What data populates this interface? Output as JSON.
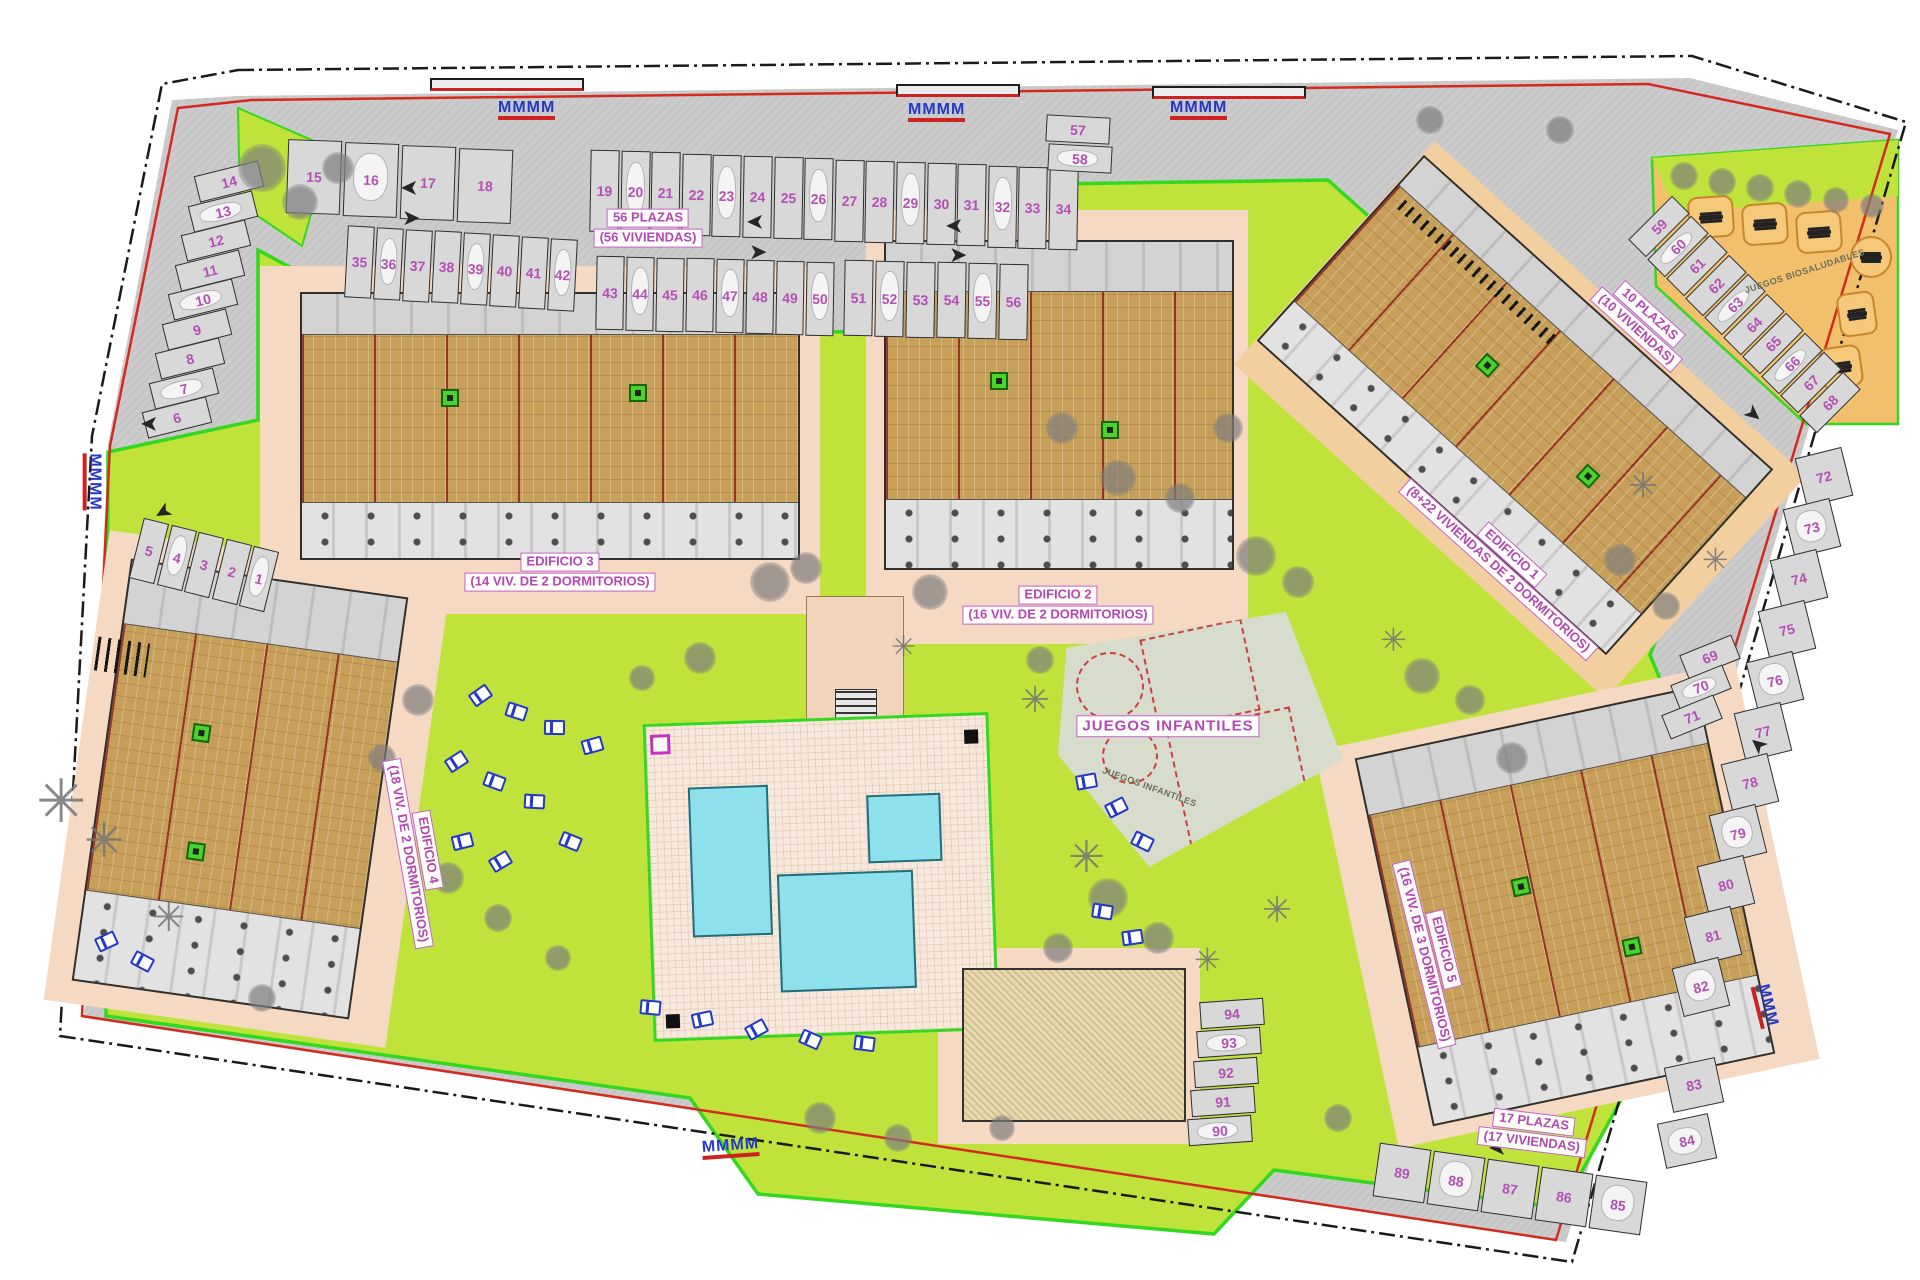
{
  "labels": {
    "plazas_top": {
      "line1": "56 PLAZAS",
      "line2": "(56 VIVIENDAS)"
    },
    "plazas_right": {
      "line1": "10 PLAZAS",
      "line2": "(10 VIVIENDAS)"
    },
    "plazas_bottom": {
      "line1": "17 PLAZAS",
      "line2": "(17 VIVIENDAS)"
    },
    "edificio1": {
      "line1": "EDIFICIO 1",
      "line2": "(8+22 VIVIENDAS DE 2 DORMITORIOS)"
    },
    "edificio2": {
      "line1": "EDIFICIO 2",
      "line2": "(16 VIV. DE 2 DORMITORIOS)"
    },
    "edificio3": {
      "line1": "EDIFICIO 3",
      "line2": "(14 VIV. DE 2 DORMITORIOS)"
    },
    "edificio4": {
      "line1": "EDIFICIO 4",
      "line2": "(18 VIV. DE 2 DORMITORIOS)"
    },
    "edificio5": {
      "line1": "EDIFICIO 5",
      "line2": "(16 VIV. DE 3 DORMITORIOS)"
    },
    "juegos_infantiles": "JUEGOS INFANTILES",
    "juegos_infantiles_small": "JUEGOS INFANTILES",
    "juegos_biosaludables": "JUEGOS BIOSALUDABLES"
  },
  "icons": {
    "arrow_glyph": "➤",
    "palm_glyph": "✳",
    "rack_glyph": "M"
  },
  "colors": {
    "parking_number": "#b44fb4",
    "label_pink": "#b348b3",
    "lime_garden": "#bfe33a",
    "boundary_green": "#33d81f",
    "boundary_red": "#d42a1e",
    "road_gray": "#cbcbcb",
    "walkway_salmon": "#f5d9c3",
    "fitness_orange": "#f2c06d",
    "building_tan": "#c79f58",
    "pool_cyan": "#8ee0ec",
    "lounger_blue": "#2338c8"
  },
  "parking_groups": [
    {
      "numbers": [
        "15",
        "16",
        "17",
        "18"
      ],
      "x": 287,
      "y": 140,
      "dx": 57,
      "dy": 3,
      "w": 54,
      "h": 74,
      "rot": 2
    },
    {
      "numbers": [
        "19",
        "20",
        "21",
        "22",
        "23",
        "24",
        "25",
        "26",
        "27",
        "28",
        "29",
        "30",
        "31",
        "32",
        "33",
        "34"
      ],
      "x": 590,
      "y": 150,
      "dx": 30.6,
      "dy": 1.2,
      "w": 29,
      "h": 82,
      "rot": 1
    },
    {
      "numbers": [
        "35",
        "36",
        "37",
        "38",
        "39",
        "40",
        "41",
        "42"
      ],
      "x": 346,
      "y": 226,
      "dx": 29,
      "dy": 1.8,
      "w": 27,
      "h": 72,
      "rot": 3
    },
    {
      "numbers": [
        "43",
        "44",
        "45",
        "46",
        "47",
        "48",
        "49",
        "50"
      ],
      "x": 596,
      "y": 256,
      "dx": 30,
      "dy": 0.8,
      "w": 28,
      "h": 74,
      "rot": 1
    },
    {
      "numbers": [
        "51",
        "52",
        "53",
        "54",
        "55",
        "56"
      ],
      "x": 844,
      "y": 260,
      "dx": 31,
      "dy": 0.8,
      "w": 29,
      "h": 76,
      "rot": 1
    },
    {
      "numbers": [
        "57",
        "58"
      ],
      "x": 1046,
      "y": 116,
      "dx": 2,
      "dy": 29,
      "w": 64,
      "h": 27,
      "rot": 3
    },
    {
      "numbers": [
        "14",
        "13",
        "12",
        "11",
        "10",
        "9",
        "8",
        "7",
        "6"
      ],
      "x": 196,
      "y": 168,
      "dx": -6.5,
      "dy": 29.5,
      "w": 66,
      "h": 27,
      "rot": -14
    },
    {
      "numbers": [
        "5",
        "4",
        "3",
        "2",
        "1"
      ],
      "x": 136,
      "y": 520,
      "dx": 27.5,
      "dy": 7,
      "w": 26,
      "h": 62,
      "rot": 14
    },
    {
      "numbers": [
        "59",
        "60",
        "61",
        "62",
        "63",
        "64",
        "65",
        "66",
        "67",
        "68"
      ],
      "x": 1628,
      "y": 214,
      "dx": 19,
      "dy": 19.5,
      "w": 62,
      "h": 25,
      "rot": -45
    },
    {
      "numbers": [
        "69",
        "70",
        "71"
      ],
      "x": 1682,
      "y": 644,
      "dx": -9,
      "dy": 30,
      "w": 56,
      "h": 26,
      "rot": -22
    },
    {
      "numbers": [
        "72",
        "73",
        "74",
        "75",
        "76",
        "77",
        "78",
        "79",
        "80",
        "81",
        "82"
      ],
      "x": 1800,
      "y": 452,
      "dx": -12.3,
      "dy": 51,
      "w": 48,
      "h": 50,
      "rot": -14
    },
    {
      "numbers": [
        "83",
        "84"
      ],
      "x": 1668,
      "y": 1062,
      "dx": -7,
      "dy": 56,
      "w": 52,
      "h": 46,
      "rot": -12
    },
    {
      "numbers": [
        "89",
        "88",
        "87",
        "86",
        "85"
      ],
      "x": 1376,
      "y": 1146,
      "dx": 54,
      "dy": 8,
      "w": 52,
      "h": 54,
      "rot": 8
    },
    {
      "numbers": [
        "94",
        "93",
        "92",
        "91",
        "90"
      ],
      "x": 1200,
      "y": 1000,
      "dx": -3,
      "dy": 29.3,
      "w": 64,
      "h": 27,
      "rot": -4
    }
  ],
  "decorations": {
    "trees": [
      [
        262,
        168,
        24
      ],
      [
        300,
        202,
        18
      ],
      [
        338,
        168,
        16
      ],
      [
        770,
        582,
        20
      ],
      [
        806,
        568,
        16
      ],
      [
        930,
        592,
        18
      ],
      [
        1256,
        556,
        20
      ],
      [
        1298,
        582,
        16
      ],
      [
        1118,
        478,
        18
      ],
      [
        1180,
        498,
        15
      ],
      [
        1062,
        428,
        16
      ],
      [
        1228,
        428,
        15
      ],
      [
        1422,
        676,
        18
      ],
      [
        1470,
        700,
        15
      ],
      [
        1512,
        758,
        16
      ],
      [
        1108,
        898,
        20
      ],
      [
        1158,
        938,
        16
      ],
      [
        1058,
        948,
        15
      ],
      [
        700,
        658,
        16
      ],
      [
        642,
        678,
        13
      ],
      [
        418,
        700,
        16
      ],
      [
        382,
        758,
        14
      ],
      [
        448,
        878,
        16
      ],
      [
        498,
        918,
        14
      ],
      [
        558,
        958,
        13
      ],
      [
        262,
        998,
        14
      ],
      [
        820,
        1118,
        16
      ],
      [
        898,
        1138,
        14
      ],
      [
        1002,
        1128,
        13
      ],
      [
        1338,
        1118,
        14
      ],
      [
        1684,
        176,
        14
      ],
      [
        1722,
        182,
        14
      ],
      [
        1760,
        188,
        14
      ],
      [
        1798,
        194,
        14
      ],
      [
        1836,
        200,
        13
      ],
      [
        1872,
        206,
        12
      ],
      [
        1560,
        130,
        14
      ],
      [
        1430,
        120,
        14
      ],
      [
        1040,
        660,
        14
      ],
      [
        1620,
        560,
        16
      ],
      [
        1666,
        606,
        14
      ]
    ],
    "palms": [
      [
        66,
        802,
        30
      ],
      [
        108,
        842,
        24
      ],
      [
        1090,
        858,
        22
      ],
      [
        1038,
        700,
        18
      ],
      [
        1396,
        640,
        16
      ],
      [
        1646,
        486,
        18
      ],
      [
        172,
        918,
        20
      ],
      [
        1718,
        560,
        16
      ],
      [
        906,
        648,
        15
      ],
      [
        1280,
        910,
        18
      ],
      [
        1210,
        960,
        16
      ]
    ],
    "loungers": [
      [
        470,
        688
      ],
      [
        506,
        704
      ],
      [
        544,
        720
      ],
      [
        582,
        738
      ],
      [
        446,
        754
      ],
      [
        484,
        774
      ],
      [
        524,
        794
      ],
      [
        452,
        834
      ],
      [
        490,
        854
      ],
      [
        560,
        834
      ],
      [
        640,
        1000
      ],
      [
        692,
        1012
      ],
      [
        746,
        1022
      ],
      [
        800,
        1032
      ],
      [
        854,
        1036
      ],
      [
        1076,
        774
      ],
      [
        1106,
        800
      ],
      [
        1132,
        834
      ],
      [
        1092,
        904
      ],
      [
        1122,
        930
      ],
      [
        96,
        934
      ],
      [
        132,
        954
      ]
    ],
    "bike_racks": [
      [
        498,
        100,
        0,
        4
      ],
      [
        908,
        102,
        0,
        4
      ],
      [
        1170,
        100,
        0,
        4
      ],
      [
        64,
        472,
        90,
        4
      ],
      [
        702,
        1138,
        -4,
        4
      ],
      [
        1744,
        996,
        76,
        3
      ]
    ],
    "arrows": [
      [
        400,
        177,
        180
      ],
      [
        402,
        207,
        0
      ],
      [
        746,
        211,
        180
      ],
      [
        749,
        241,
        0
      ],
      [
        945,
        215,
        180
      ],
      [
        949,
        244,
        0
      ],
      [
        140,
        413,
        180
      ],
      [
        154,
        501,
        150
      ],
      [
        1744,
        403,
        40
      ],
      [
        1749,
        734,
        220
      ],
      [
        1488,
        1137,
        180
      ]
    ],
    "fitness_pads": [
      [
        1688,
        196,
        46,
        42,
        -4,
        0
      ],
      [
        1742,
        203,
        46,
        42,
        -4,
        0
      ],
      [
        1796,
        211,
        46,
        42,
        -4,
        0
      ],
      [
        1850,
        236,
        42,
        42,
        0,
        1
      ],
      [
        1838,
        292,
        38,
        44,
        -8,
        0
      ],
      [
        1820,
        346,
        42,
        42,
        -8,
        0
      ]
    ]
  }
}
